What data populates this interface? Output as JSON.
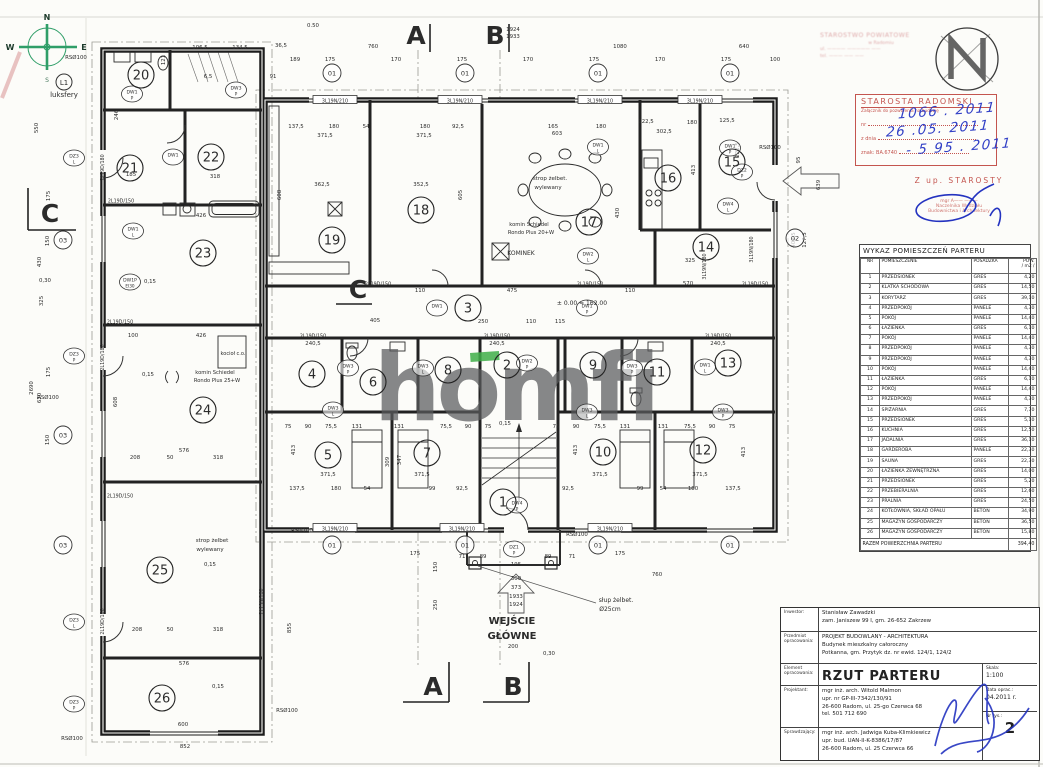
{
  "watermark": {
    "text": "homfi",
    "gray": "#5a5b5d",
    "green": "#3fae49"
  },
  "compass": {
    "n": "N",
    "w": "W",
    "e": "E",
    "s": "S"
  },
  "room_schedule": {
    "title": "WYKAZ POMIESZCZEŃ PARTERU",
    "columns": [
      "NR",
      "POMIESZCZENIE",
      "POSADZKA",
      "POW."
    ],
    "pow_unit": "/ m2 /",
    "rows": [
      [
        "1",
        "PRZEDSIONEK",
        "GRES",
        "4,20"
      ],
      [
        "2",
        "KLATKA SCHODOWA",
        "GRES",
        "14,50"
      ],
      [
        "3",
        "KORYTARZ",
        "GRES",
        "39,10"
      ],
      [
        "4",
        "PRZEDPOKÓJ",
        "PANELE",
        "4,30"
      ],
      [
        "5",
        "POKÓJ",
        "PANELE",
        "14,40"
      ],
      [
        "6",
        "ŁAZIENKA",
        "GRES",
        "6,10"
      ],
      [
        "7",
        "POKÓJ",
        "PANELE",
        "14,40"
      ],
      [
        "8",
        "PRZEDPOKÓJ",
        "PANELE",
        "4,30"
      ],
      [
        "9",
        "PRZEDPOKÓJ",
        "PANELE",
        "4,30"
      ],
      [
        "10",
        "POKÓJ",
        "PANELE",
        "14,40"
      ],
      [
        "11",
        "ŁAZIENKA",
        "GRES",
        "6,10"
      ],
      [
        "12",
        "POKÓJ",
        "PANELE",
        "14,40"
      ],
      [
        "13",
        "PRZEDPOKÓJ",
        "PANELE",
        "4,30"
      ],
      [
        "14",
        "SPIŻARNIA",
        "GRES",
        "7,70"
      ],
      [
        "15",
        "PRZEDSIONEK",
        "GRES",
        "5,10"
      ],
      [
        "16",
        "KUCHNIA",
        "GRES",
        "12,50"
      ],
      [
        "17",
        "JADALNIA",
        "GRES",
        "36,10"
      ],
      [
        "18",
        "GARDEROBA",
        "PANELE",
        "22,30"
      ],
      [
        "19",
        "SAUNA",
        "GRES",
        "22,30"
      ],
      [
        "20",
        "ŁAZIENKA ZEWNĘTRZNA",
        "GRES",
        "14,00"
      ],
      [
        "21",
        "PRZEDSIONEK",
        "GRES",
        "5,20"
      ],
      [
        "22",
        "PRZEBIERALNIA",
        "GRES",
        "12,60"
      ],
      [
        "23",
        "PRALNIA",
        "GRES",
        "24,50"
      ],
      [
        "24",
        "KOTŁOWNIA, SKŁAD OPAŁU",
        "BETON",
        "34,90"
      ],
      [
        "25",
        "MAGAZYN GOSPODARCZY",
        "BETON",
        "36,50"
      ],
      [
        "26",
        "MAGAZYN GOSPODARCZY",
        "BETON",
        "15,80"
      ]
    ],
    "total_label": "RAZEM POWIERZCHNIA PARTERU",
    "total_value": "394,40"
  },
  "title_block": {
    "inwestor_label": "Inwestor:",
    "inwestor_l1": "Stanisław Zawadzki",
    "inwestor_l2": "zam. Janiszew 99 I, gm. 26-652 Zakrzew",
    "przedmiot_label": "Przedmiot opracowania:",
    "przedmiot_l1": "PROJEKT BUDOWLANY - ARCHITEKTURA",
    "przedmiot_l2": "Budynek mieszkalny całoroczny",
    "przedmiot_l3": "Potkanna, gm. Przytyk dz. nr ewid. 124/1, 124/2",
    "element_label": "Element opracowania:",
    "element_value": "RZUT PARTERU",
    "skala_label": "Skala:",
    "skala_value": "1:100",
    "projektant_label": "Projektant:",
    "projektant_l1": "mgr inż. arch. Witold Malmon",
    "projektant_l2": "upr. nr GP-III-7342/130/91",
    "projektant_l3": "26-600 Radom, ul. 25-go Czerwca 68",
    "projektant_l4": "tel. 501 712 690",
    "data_label": "Data oprac.:",
    "data_value": "04.2011 r.",
    "sprawdzajacy_label": "Sprawdzający:",
    "sprawdzajacy_l1": "mgr inż. arch. Jadwiga Kuba-Klimkiewicz",
    "sprawdzajacy_l2": "upr. bud. UAN-II-K-8386/17/87",
    "sprawdzajacy_l3": "26-600 Radom, ul. 25 Czerwca 66",
    "nr_label": "Nr rys.:",
    "nr_value": "2"
  },
  "stamps": {
    "approval": {
      "title": "STAROSTA RADOMSKI",
      "subtitle": "Załącznik do pozwolenia na budowę",
      "nr_label": "nr",
      "date_label": "z dnia",
      "sign_label": "znak: BA.6740",
      "hand_nr": "1066 . 2011",
      "hand_date": "26 .05. 2011",
      "hand_sign": "- 5 95 . 2011"
    },
    "authority": {
      "l1": "Z up. STAROSTY",
      "l2": "mgr A—— ———",
      "l3": "Naczelnika Wydziału",
      "l4": "Budownictwa i Architektury"
    },
    "faint": {
      "l1": "STAROSTWO POWIATOWE",
      "l2": "w Radomiu",
      "l3": "ul. ———— ————— ——",
      "l4": "tel. ——— —— ——"
    }
  },
  "plan": {
    "rooms": [
      "1",
      "2",
      "3",
      "4",
      "5",
      "6",
      "7",
      "8",
      "9",
      "10",
      "11",
      "12",
      "13",
      "14",
      "15",
      "16",
      "17",
      "18",
      "19",
      "20",
      "21",
      "22",
      "23",
      "24",
      "25",
      "26"
    ],
    "section_markers": [
      "A",
      "B",
      "A",
      "B",
      "C",
      "C"
    ],
    "opening_markers": [
      "01",
      "01",
      "01",
      "01",
      "01",
      "01",
      "01",
      "01",
      "02",
      "03",
      "03",
      "03"
    ],
    "rs_labels": [
      "RSØ100",
      "RSØ100",
      "RSØ100",
      "RSØ100",
      "RSØ100",
      "RSØ100",
      "RSØ100"
    ],
    "labels": {
      "l1_tag": "L1"
    },
    "annotations": [
      "WEJŚCIE",
      "GŁÓWNE",
      "słup żelbet.",
      "Ø25cm",
      "luksfery",
      "kocioł c.o.",
      "komin Schiedel",
      "Rondo Plus 25+W",
      "komin Schiedel",
      "Rondo Plus 20+W",
      "KOMINEK",
      "strop żelbet.",
      "wylewany",
      "strop żelbet",
      "wylewany",
      "± 0.00 = 162.00"
    ],
    "lintel_labels": [
      "3L19N/210",
      "3L19N/210",
      "3L19N/210",
      "3L19N/210",
      "3L19N/210",
      "3L19N/210",
      "3L19N/210",
      "2L19D/150",
      "2L19D/150",
      "2L19D/150",
      "2L19D/150",
      "2L19D/150",
      "2L19D/150",
      "2L19D/150",
      "2L19D/150",
      "2L19D/150",
      "2L19D/180",
      "2L19D/180",
      "2L19D/180",
      "3L19N/180",
      "3L19N/180",
      "2L19N/180"
    ],
    "door_tags": [
      {
        "l1": "DW1",
        "l2": "P"
      },
      {
        "l1": "DW3",
        "l2": "P"
      },
      {
        "l1": "DW1",
        "l2": ""
      },
      {
        "l1": "DW1",
        "l2": "L"
      },
      {
        "l1": "DW1P",
        "l2": "EI30"
      },
      {
        "l1": "DZ3",
        "l2": "L"
      },
      {
        "l1": "DZ3",
        "l2": "P"
      },
      {
        "l1": "DZ3",
        "l2": "L"
      },
      {
        "l1": "DZ3",
        "l2": "P"
      },
      {
        "l1": "DW1",
        "l2": ""
      },
      {
        "l1": "DW1",
        "l2": "P"
      },
      {
        "l1": "DW1",
        "l2": "L"
      },
      {
        "l1": "DW2",
        "l2": "L"
      },
      {
        "l1": "DW1",
        "l2": "P"
      },
      {
        "l1": "DZ2",
        "l2": "P"
      },
      {
        "l1": "DW4",
        "l2": "L"
      },
      {
        "l1": "DW3",
        "l2": "P"
      },
      {
        "l1": "DW3",
        "l2": "L"
      },
      {
        "l1": "DW2",
        "l2": "P"
      },
      {
        "l1": "DW3",
        "l2": "P"
      },
      {
        "l1": "DW1",
        "l2": "L"
      },
      {
        "l1": "DW3",
        "l2": "L"
      },
      {
        "l1": "DW3",
        "l2": "L"
      },
      {
        "l1": "DW3",
        "l2": "P"
      },
      {
        "l1": "DW4",
        "l2": "P"
      },
      {
        "l1": "DZ1",
        "l2": "P"
      }
    ],
    "dim_labels": [
      "0.50",
      "36,5",
      "189",
      "91",
      "760",
      "1080",
      "640",
      "175",
      "170",
      "175",
      "170",
      "175",
      "170",
      "175",
      "1924",
      "1933",
      "550",
      "430",
      "325",
      "2690",
      "630",
      "175",
      "150",
      "175",
      "150",
      "852",
      "855",
      "600",
      "576",
      "208",
      "50",
      "318",
      "371,5",
      "362,5",
      "137,5",
      "180",
      "54",
      "371,5",
      "352,5",
      "180",
      "92,5",
      "608",
      "605",
      "165",
      "603",
      "180",
      "302,5",
      "430",
      "413",
      "122,5",
      "180",
      "125,5",
      "222,5",
      "570",
      "325",
      "100",
      "405",
      "250",
      "110",
      "115",
      "475",
      "110",
      "110",
      "240,5",
      "240,5",
      "240,5",
      "75",
      "90",
      "75,5",
      "131",
      "131",
      "75,5",
      "90",
      "75",
      "75",
      "90",
      "75,5",
      "131",
      "131",
      "75,5",
      "90",
      "75",
      "371,5",
      "137,5",
      "180",
      "54",
      "99",
      "371,5",
      "92,5",
      "413",
      "309",
      "347",
      "371,5",
      "371,5",
      "92,5",
      "99",
      "54",
      "180",
      "137,5",
      "413",
      "413",
      "89",
      "71",
      "89",
      "71",
      "175",
      "175",
      "150",
      "250",
      "195",
      "300",
      "373",
      "1933",
      "1924",
      "200",
      "639",
      "402,5",
      "127,5",
      "95",
      "760",
      "426",
      "100",
      "426",
      "318",
      "185",
      "106,5",
      "134,5",
      "6,5",
      "246",
      "121",
      "208",
      "50",
      "318",
      "576",
      "608",
      "0,15",
      "0,15",
      "0,15",
      "0,15",
      "0,15",
      "0,30",
      "0,30"
    ]
  }
}
